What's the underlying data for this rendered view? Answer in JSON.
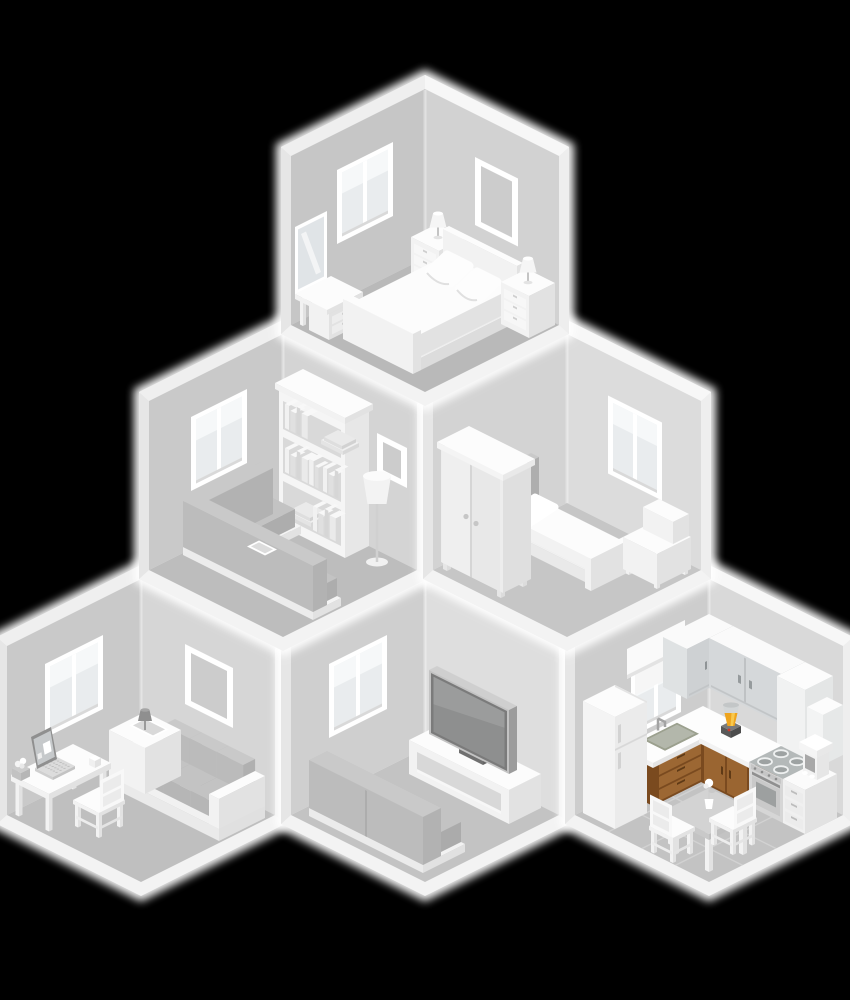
{
  "scene": {
    "description": "Isometric cutaway illustration of a six-room house arranged in a pyramid: master bedroom on top, living room and guest bedroom in the middle row, home office, TV lounge and kitchen on the bottom row",
    "background": "#000000",
    "glow": "#ffffff"
  },
  "palette": {
    "shell": {
      "slab_left": "#efefef",
      "slab_right": "#f7f7f7",
      "outer_left": "#e6e6e6",
      "outer_right": "#eeeeee",
      "plinth": "#f3f3f3"
    },
    "rooms": {
      "master-bedroom": {
        "wall_left": "#c6c6c6",
        "wall_right": "#d2d2d2",
        "floor": "#b9b9b9"
      },
      "living-room": {
        "wall_left": "#c9c9c9",
        "wall_right": "#d4d4d4",
        "floor": "#bdbdbd"
      },
      "guest-bedroom": {
        "wall_left": "#d3d3d3",
        "wall_right": "#dcdcdc",
        "floor": "#c6c6c6"
      },
      "home-office": {
        "wall_left": "#c9c9c9",
        "wall_right": "#d6d6d6",
        "floor": "#bfbfbf"
      },
      "tv-lounge": {
        "wall_left": "#cfcfcf",
        "wall_right": "#dedede",
        "floor": "#c3c3c3"
      },
      "kitchen": {
        "wall_left": "#cdcdcd",
        "wall_right": "#d9d9d9",
        "floor": "#c3c3c3",
        "tile_line": "#d2d2d2"
      }
    },
    "furniture": {
      "white_top": "#fcfcfc",
      "white_left": "#f2f2f2",
      "white_right": "#e2e2e2",
      "white_line": "#d2d2d2",
      "fabric_top": "#cbcbcb",
      "fabric_left": "#bcbcbc",
      "fabric_right": "#b0b0b0",
      "glass": "#e9ecee",
      "mirror": "#e0e4e7",
      "tv_screen": "#8e8f8f",
      "tv_bezel": "#7b7b7b",
      "tv_frame": "#c3c3c3",
      "wood_dark": "#7a4a1f",
      "wood_mid": "#9c6733",
      "wood_door": "#9a6531",
      "wood_handle": "#5f3a16",
      "blender_yellow": "#eea41e",
      "blender_highlight": "#f9c94e",
      "blender_base": "#585858",
      "blender_red": "#cf3a2c",
      "blender_cup": "#d3d6d7",
      "steel": "#b4b9b9",
      "sink": "#b3b7ab",
      "cabinet_front": "#d2d5d7",
      "headboard": "#b9b9b9",
      "lamp_dark": "#8f8f8f"
    }
  },
  "rooms": [
    {
      "id": "home-office",
      "name": "Home office",
      "grid": "bottom-left",
      "furniture": [
        "window",
        "picture-frame",
        "sofa",
        "side-table",
        "desk-lamp",
        "desk",
        "laptop",
        "plant-pot",
        "desk-chair"
      ]
    },
    {
      "id": "tv-lounge",
      "name": "TV lounge",
      "grid": "bottom-center",
      "furniture": [
        "window",
        "tv-stand",
        "tv",
        "sofa"
      ]
    },
    {
      "id": "kitchen",
      "name": "Kitchen",
      "grid": "bottom-right",
      "furniture": [
        "floor-tiles",
        "window",
        "upper-cabinets",
        "tall-cabinet",
        "wall-cabinet",
        "kitchen-counter",
        "sink",
        "blender",
        "stove",
        "drawer-unit",
        "coffee-maker",
        "fridge",
        "dining-table",
        "flower-vase",
        "dining-chair-left",
        "dining-chair-right"
      ]
    },
    {
      "id": "living-room",
      "name": "Living room",
      "grid": "middle-left",
      "furniture": [
        "window",
        "bookshelf",
        "picture-frame",
        "floor-lamp",
        "corner-sofa"
      ]
    },
    {
      "id": "guest-bedroom",
      "name": "Guest bedroom",
      "grid": "middle-right",
      "furniture": [
        "window",
        "single-bed",
        "storage-unit",
        "wardrobe"
      ]
    },
    {
      "id": "master-bedroom",
      "name": "Master bedroom",
      "grid": "top",
      "furniture": [
        "window",
        "picture-frame",
        "standing-mirror",
        "vanity-desk",
        "stool",
        "nightstand-left",
        "double-bed",
        "nightstand-right"
      ]
    }
  ]
}
